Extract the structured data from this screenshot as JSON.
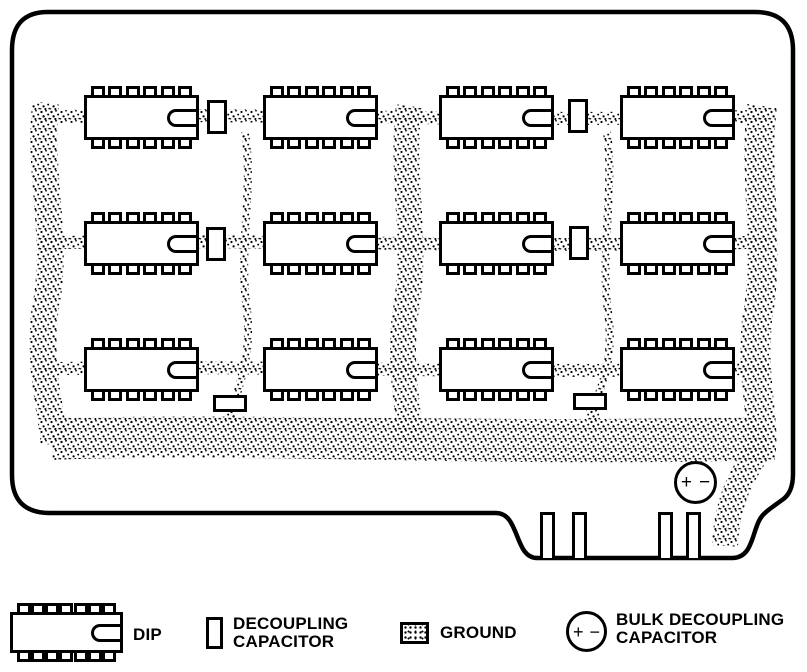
{
  "colors": {
    "ink": "#000000",
    "paper": "#ffffff"
  },
  "board": {
    "grid_rows": 3,
    "grid_cols": 4,
    "dip_pins_per_side": 6,
    "edge_connector_fingers": 4,
    "bulk_capacitor": {
      "plus": "+",
      "minus": "−"
    }
  },
  "legend": {
    "dip_pins_per_side": 7,
    "items": [
      {
        "icon": "dip-icon",
        "label_lines": [
          "DIP"
        ]
      },
      {
        "icon": "decoupling-capacitor-icon",
        "label_lines": [
          "DECOUPLING",
          "CAPACITOR"
        ]
      },
      {
        "icon": "ground-icon",
        "label_lines": [
          "GROUND"
        ]
      },
      {
        "icon": "bulk-decoupling-capacitor-icon",
        "label_lines": [
          "BULK DECOUPLING",
          "CAPACITOR"
        ],
        "plus": "+",
        "minus": "−"
      }
    ]
  }
}
